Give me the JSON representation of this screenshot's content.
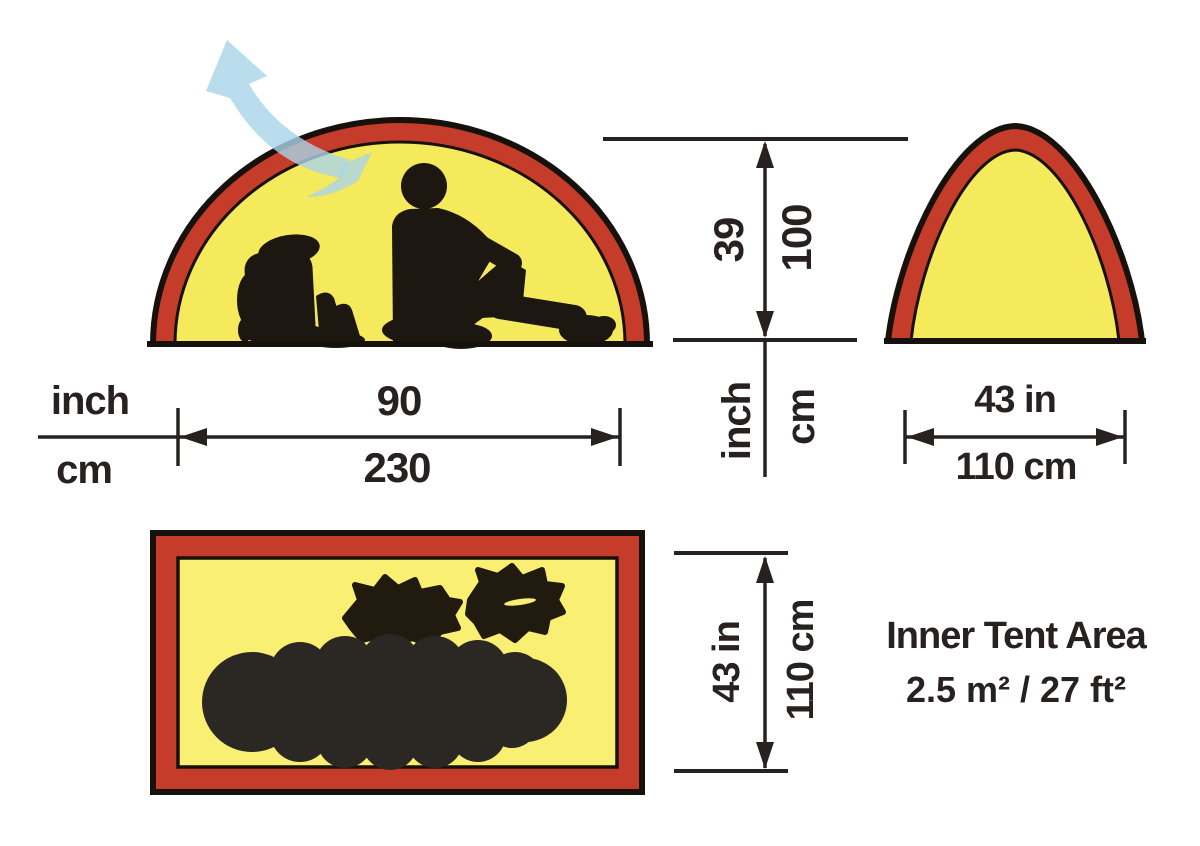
{
  "colors": {
    "red": "#c63c2a",
    "tent-yellow": "#f5e95c",
    "floor-yellow": "#f9ef72",
    "ink": "#272220",
    "outline": "#17110b",
    "silhouette": "#1c1711",
    "gear-blob": "#201b0e",
    "sleeping-bag": "#2b2723",
    "vent-blue": "#a9d5e8"
  },
  "scale_key": {
    "inch_label": "inch",
    "cm_label": "cm"
  },
  "tent_width": {
    "inch": "90",
    "cm": "230"
  },
  "tent_height": {
    "inch": "39",
    "cm": "100",
    "inch_unit": "inch",
    "cm_unit": "cm"
  },
  "front_width": {
    "inch": "43 in",
    "cm": "110 cm"
  },
  "floor_depth": {
    "inch": "43 in",
    "cm": "110 cm"
  },
  "inner_area": {
    "title": "Inner Tent Area",
    "value": "2.5 m² / 27 ft²"
  },
  "icons": {
    "ventilation_arrow": "curved-airflow-arrow"
  }
}
